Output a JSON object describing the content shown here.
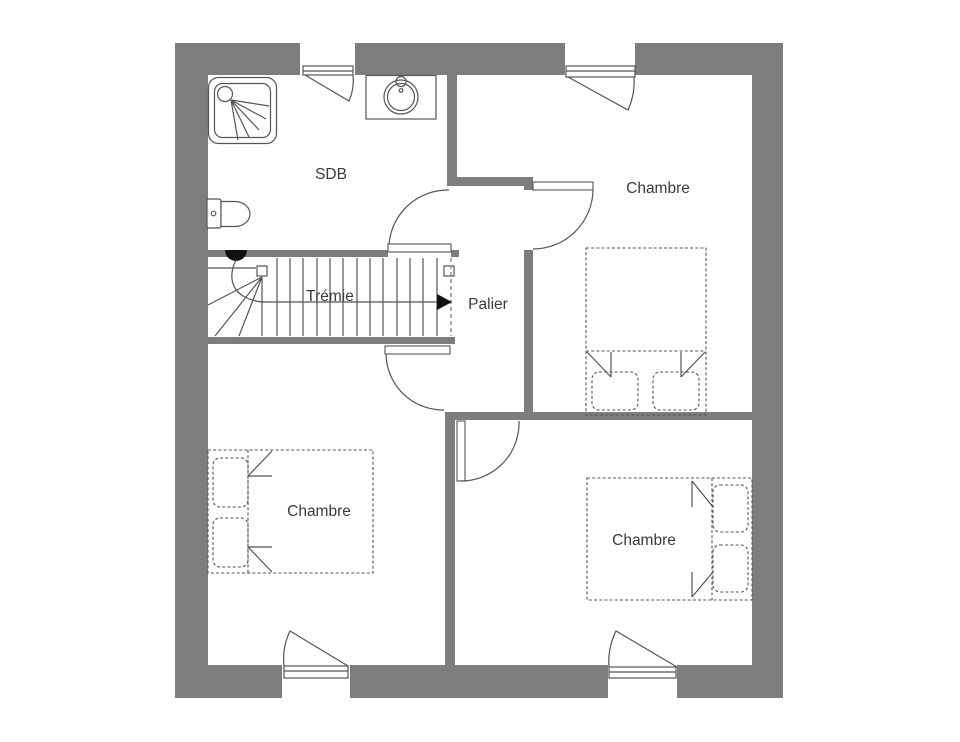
{
  "floor_plan": {
    "type": "architectural-floor-plan",
    "rooms": {
      "sdb": {
        "label": "SDB"
      },
      "chambre_top_right": {
        "label": "Chambre"
      },
      "palier": {
        "label": "Palier"
      },
      "tremie": {
        "label": "Trémie"
      },
      "chambre_bottom_left": {
        "label": "Chambre"
      },
      "chambre_bottom_right": {
        "label": "Chambre"
      }
    },
    "fixtures": [
      "shower",
      "sink",
      "toilet",
      "stairs",
      "double-bed",
      "double-bed",
      "double-bed"
    ],
    "windows_count": 4,
    "doors_count": 4,
    "colors": {
      "wall": "#7d7d7d",
      "line": "#555555",
      "text": "#3b3b3b",
      "marker": "#111111",
      "background": "#ffffff"
    }
  }
}
